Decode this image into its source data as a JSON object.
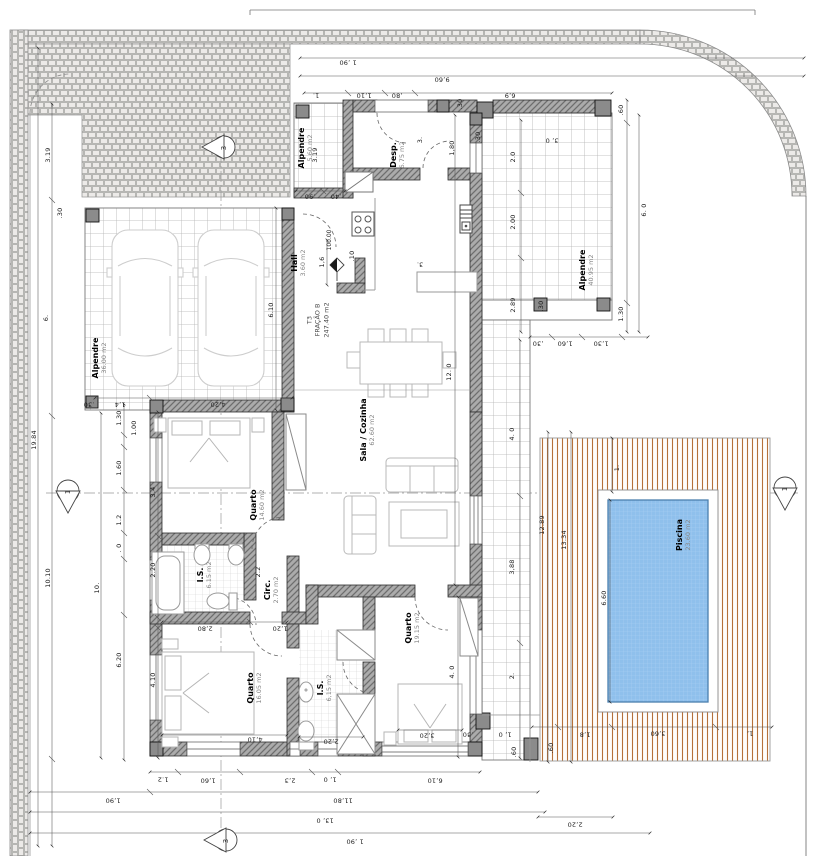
{
  "drawing_type": "floor-plan",
  "unit_label": {
    "line1": "T3",
    "line2": "FRAÇÃO B",
    "line3": "247.40 m2"
  },
  "site": {
    "level": "100.00"
  },
  "rooms": [
    {
      "name": "Alpendre",
      "area": "5.60 m2"
    },
    {
      "name": "Desp.",
      "area": "6.75 m2"
    },
    {
      "name": "Hall",
      "area": "3.60 m2"
    },
    {
      "name": "Alpendre",
      "area": "36.00 m2"
    },
    {
      "name": "Alpendre",
      "area": "40.95 m2"
    },
    {
      "name": "Sala / Cozinha",
      "area": "62.60 m2"
    },
    {
      "name": "Quarto",
      "area": "14.60 m2"
    },
    {
      "name": "I.S.",
      "area": "6.15 m2"
    },
    {
      "name": "Circ.",
      "area": "2.70 m2"
    },
    {
      "name": "Quarto",
      "area": "16.05 m2"
    },
    {
      "name": "I.S.",
      "area": "6,15 m2"
    },
    {
      "name": "Quarto",
      "area": "19.15 m2"
    },
    {
      "name": "Piscina",
      "area": "23.60 m2"
    }
  ],
  "sections": [
    "1",
    "1",
    "3",
    "3"
  ],
  "dims": [
    "1 ,90",
    "9,60",
    "1.",
    "1,10",
    ",80",
    "6,9",
    ".60",
    "3, 0",
    "2.0",
    "2.00",
    "6. 0",
    "2.89",
    "1.30",
    ".30",
    "1,60",
    "1,30",
    ",30",
    "1,80",
    ".30",
    "3.",
    "19.84",
    "10.10",
    "10.",
    "3.19",
    "6.",
    ".30",
    ".30",
    "1,4",
    "4,20",
    "6.10",
    "1.30",
    "1.00",
    "1.60",
    "1.2",
    ". 0",
    "3.4",
    "2.20",
    "6.20",
    "4.10",
    "2.2",
    "12. 0",
    "4. 0",
    "2.",
    "3,88",
    "4. 0",
    "12.89",
    "13.34",
    "6.60",
    "1.",
    "1,8",
    "3,60",
    "1,",
    ".60",
    ".60",
    "1, 0",
    ".30",
    "1.2",
    "1,60",
    "2,3",
    "1, 0",
    "6,10",
    "1,90",
    "11,80",
    "13, 0",
    "1 ,90",
    "2,20",
    "2,80",
    "1,20",
    "4,10",
    "2,20",
    "3,20",
    ".90",
    ".40",
    "1,6",
    ".10",
    "3.",
    ".30",
    "3.19"
  ],
  "colors": {
    "wall": "#a8a8a8",
    "deck_stripe": "#b5713a",
    "pool_water": "#8fc0ec",
    "pool_edge": "#4c7fae"
  }
}
